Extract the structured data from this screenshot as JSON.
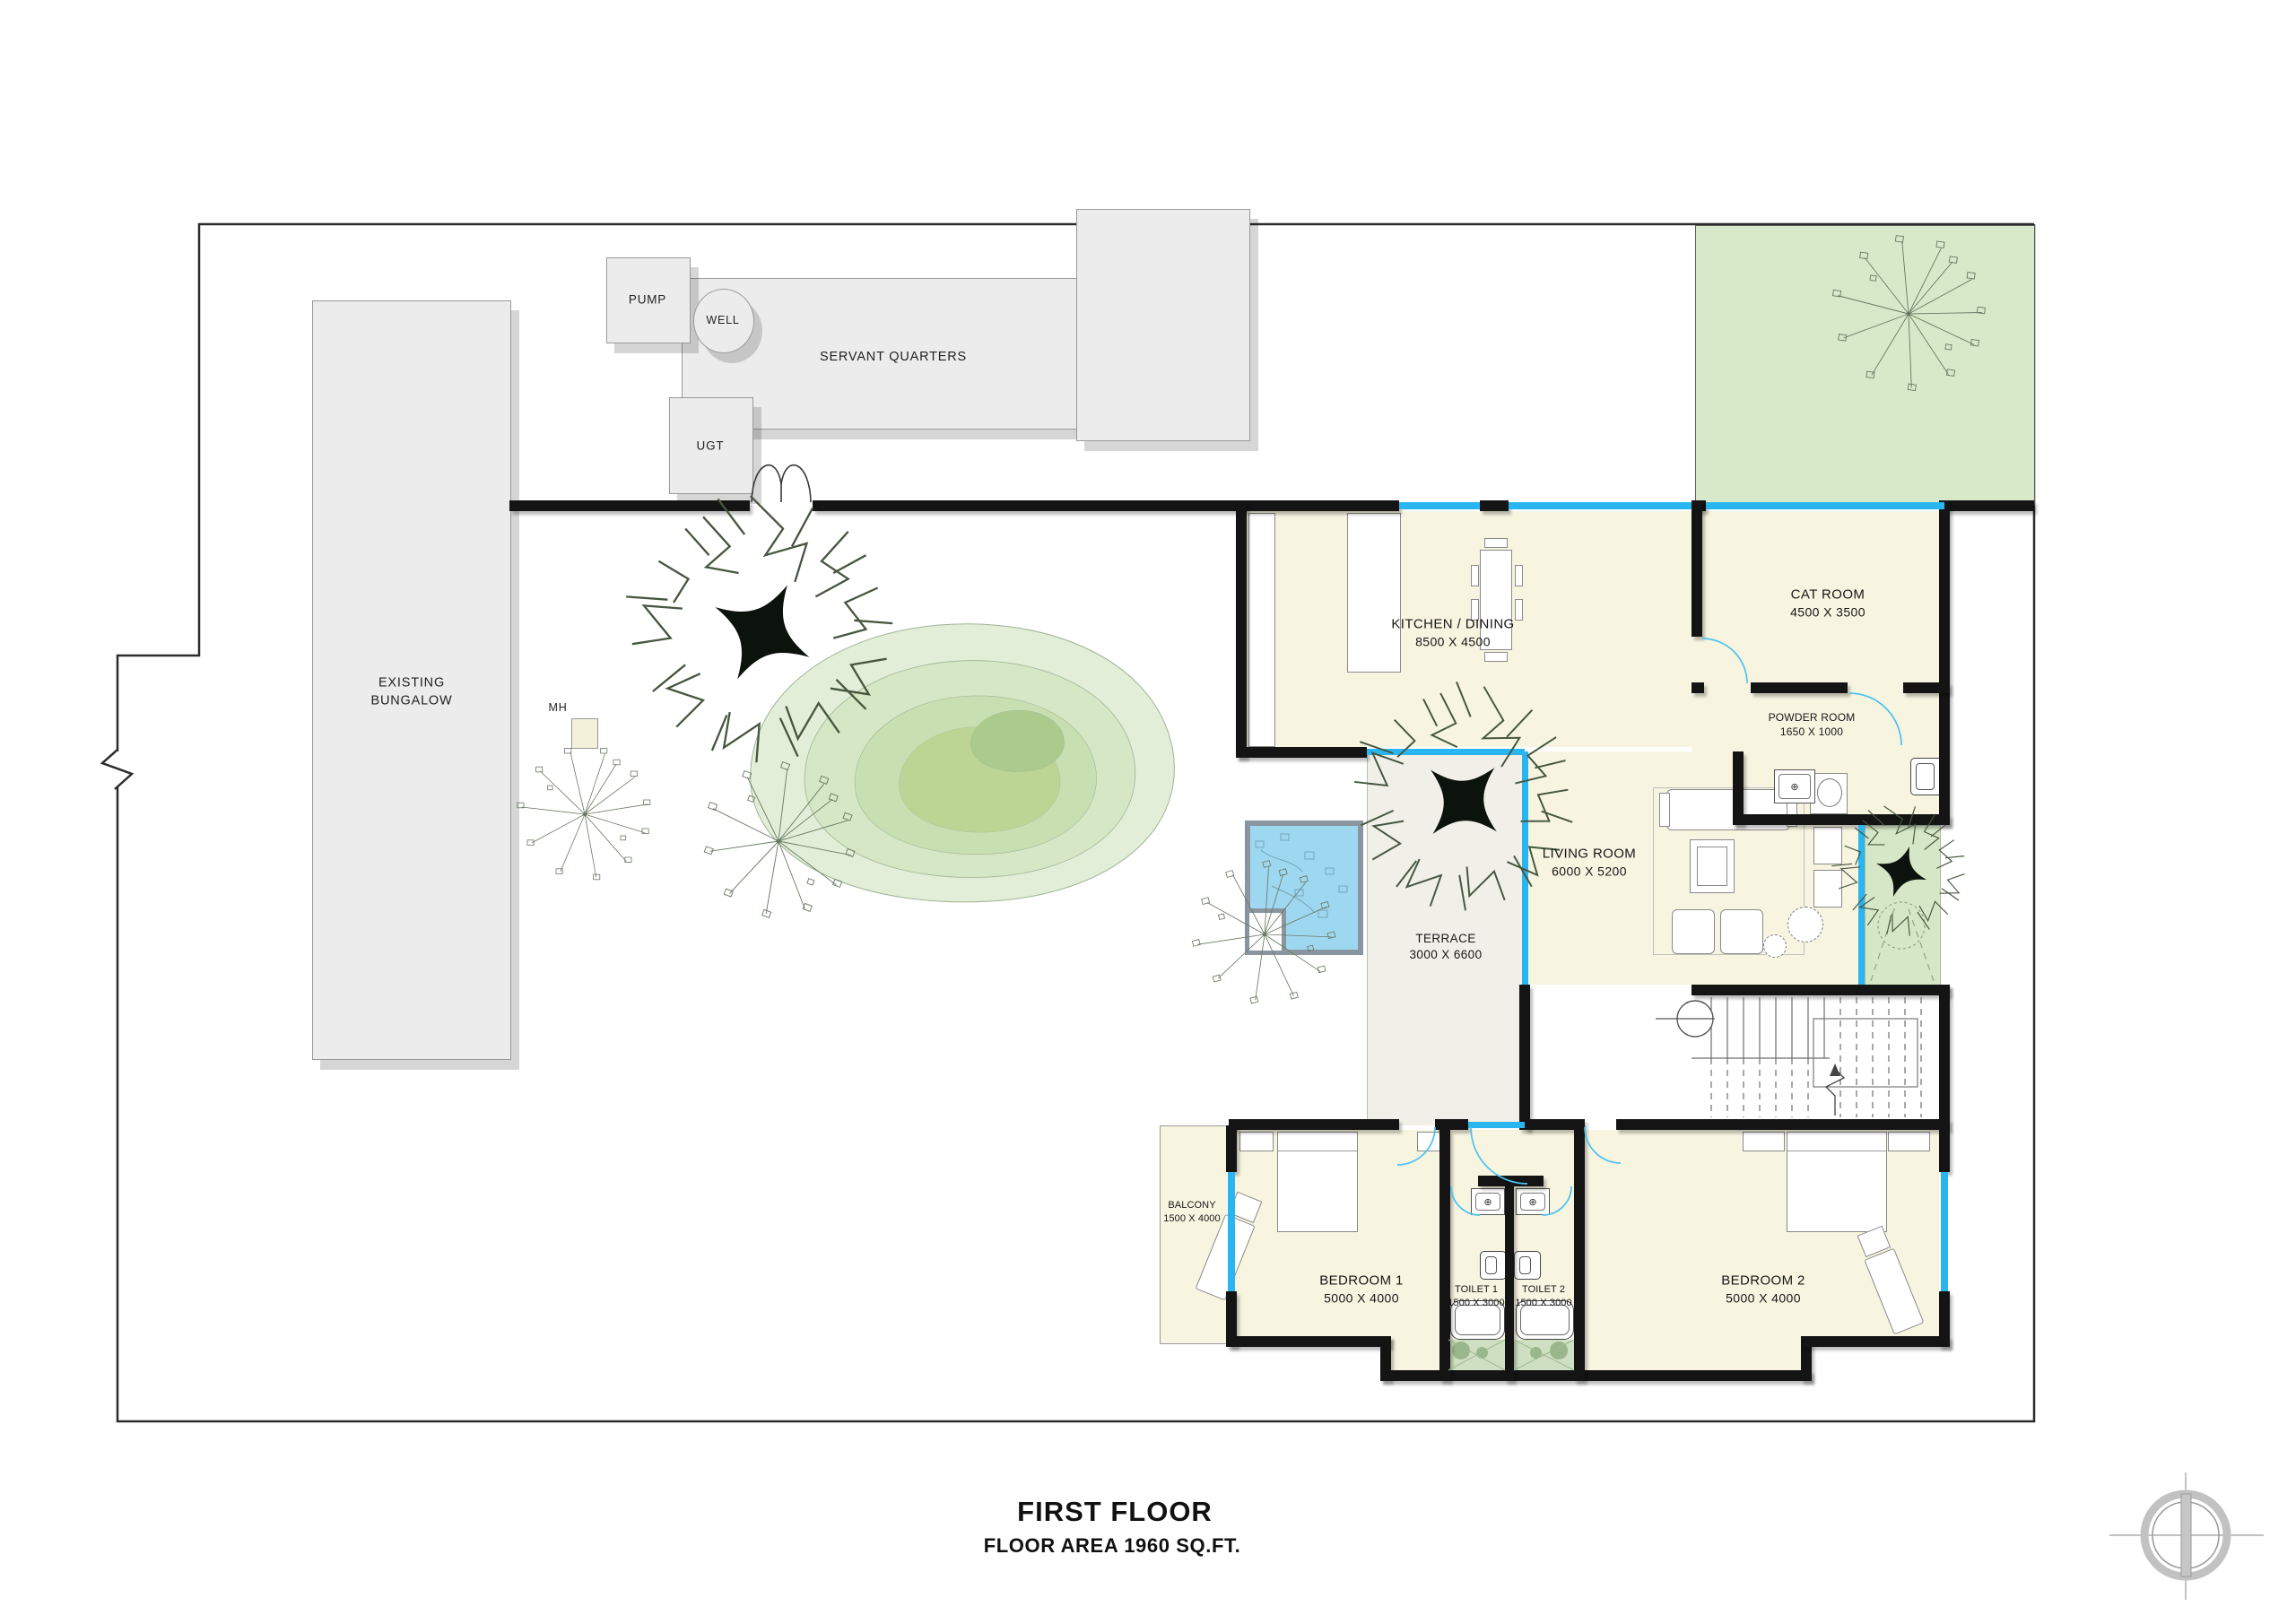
{
  "title_block": {
    "title": "FIRST FLOOR",
    "subtitle": "FLOOR AREA 1960 SQ.FT."
  },
  "site": {
    "existing_bungalow": "EXISTING BUNGALOW",
    "servant_quarters": "SERVANT QUARTERS",
    "pump": "PUMP",
    "well": "WELL",
    "ugt": "UGT",
    "manhole": "MH"
  },
  "rooms": {
    "kitchen": {
      "name": "KITCHEN / DINING",
      "dims": "8500 X 4500"
    },
    "cat": {
      "name": "CAT ROOM",
      "dims": "4500 X 3500"
    },
    "powder": {
      "name": "POWDER ROOM",
      "dims": "1650 X 1000"
    },
    "living": {
      "name": "LIVING ROOM",
      "dims": "6000 X 5200"
    },
    "terrace": {
      "name": "TERRACE",
      "dims": "3000 X 6600"
    },
    "balcony": {
      "name": "BALCONY",
      "dims": "1500 X 4000"
    },
    "bedroom1": {
      "name": "BEDROOM 1",
      "dims": "5000 X 4000"
    },
    "bedroom2": {
      "name": "BEDROOM 2",
      "dims": "5000 X 4000"
    },
    "toilet1": {
      "name": "TOILET 1",
      "dims": "1500 X 3000"
    },
    "toilet2": {
      "name": "TOILET 2",
      "dims": "1500 X 3000"
    }
  },
  "colors": {
    "wall": "#141414",
    "window": "#29b6f0",
    "room_fill": "#f7f4e0",
    "garden": "#eaf2e2",
    "garden_block": "#d8e9ca",
    "pond": "#9ed8f0",
    "building": "#ececec",
    "toilet_floor": "#cfe0c2"
  }
}
